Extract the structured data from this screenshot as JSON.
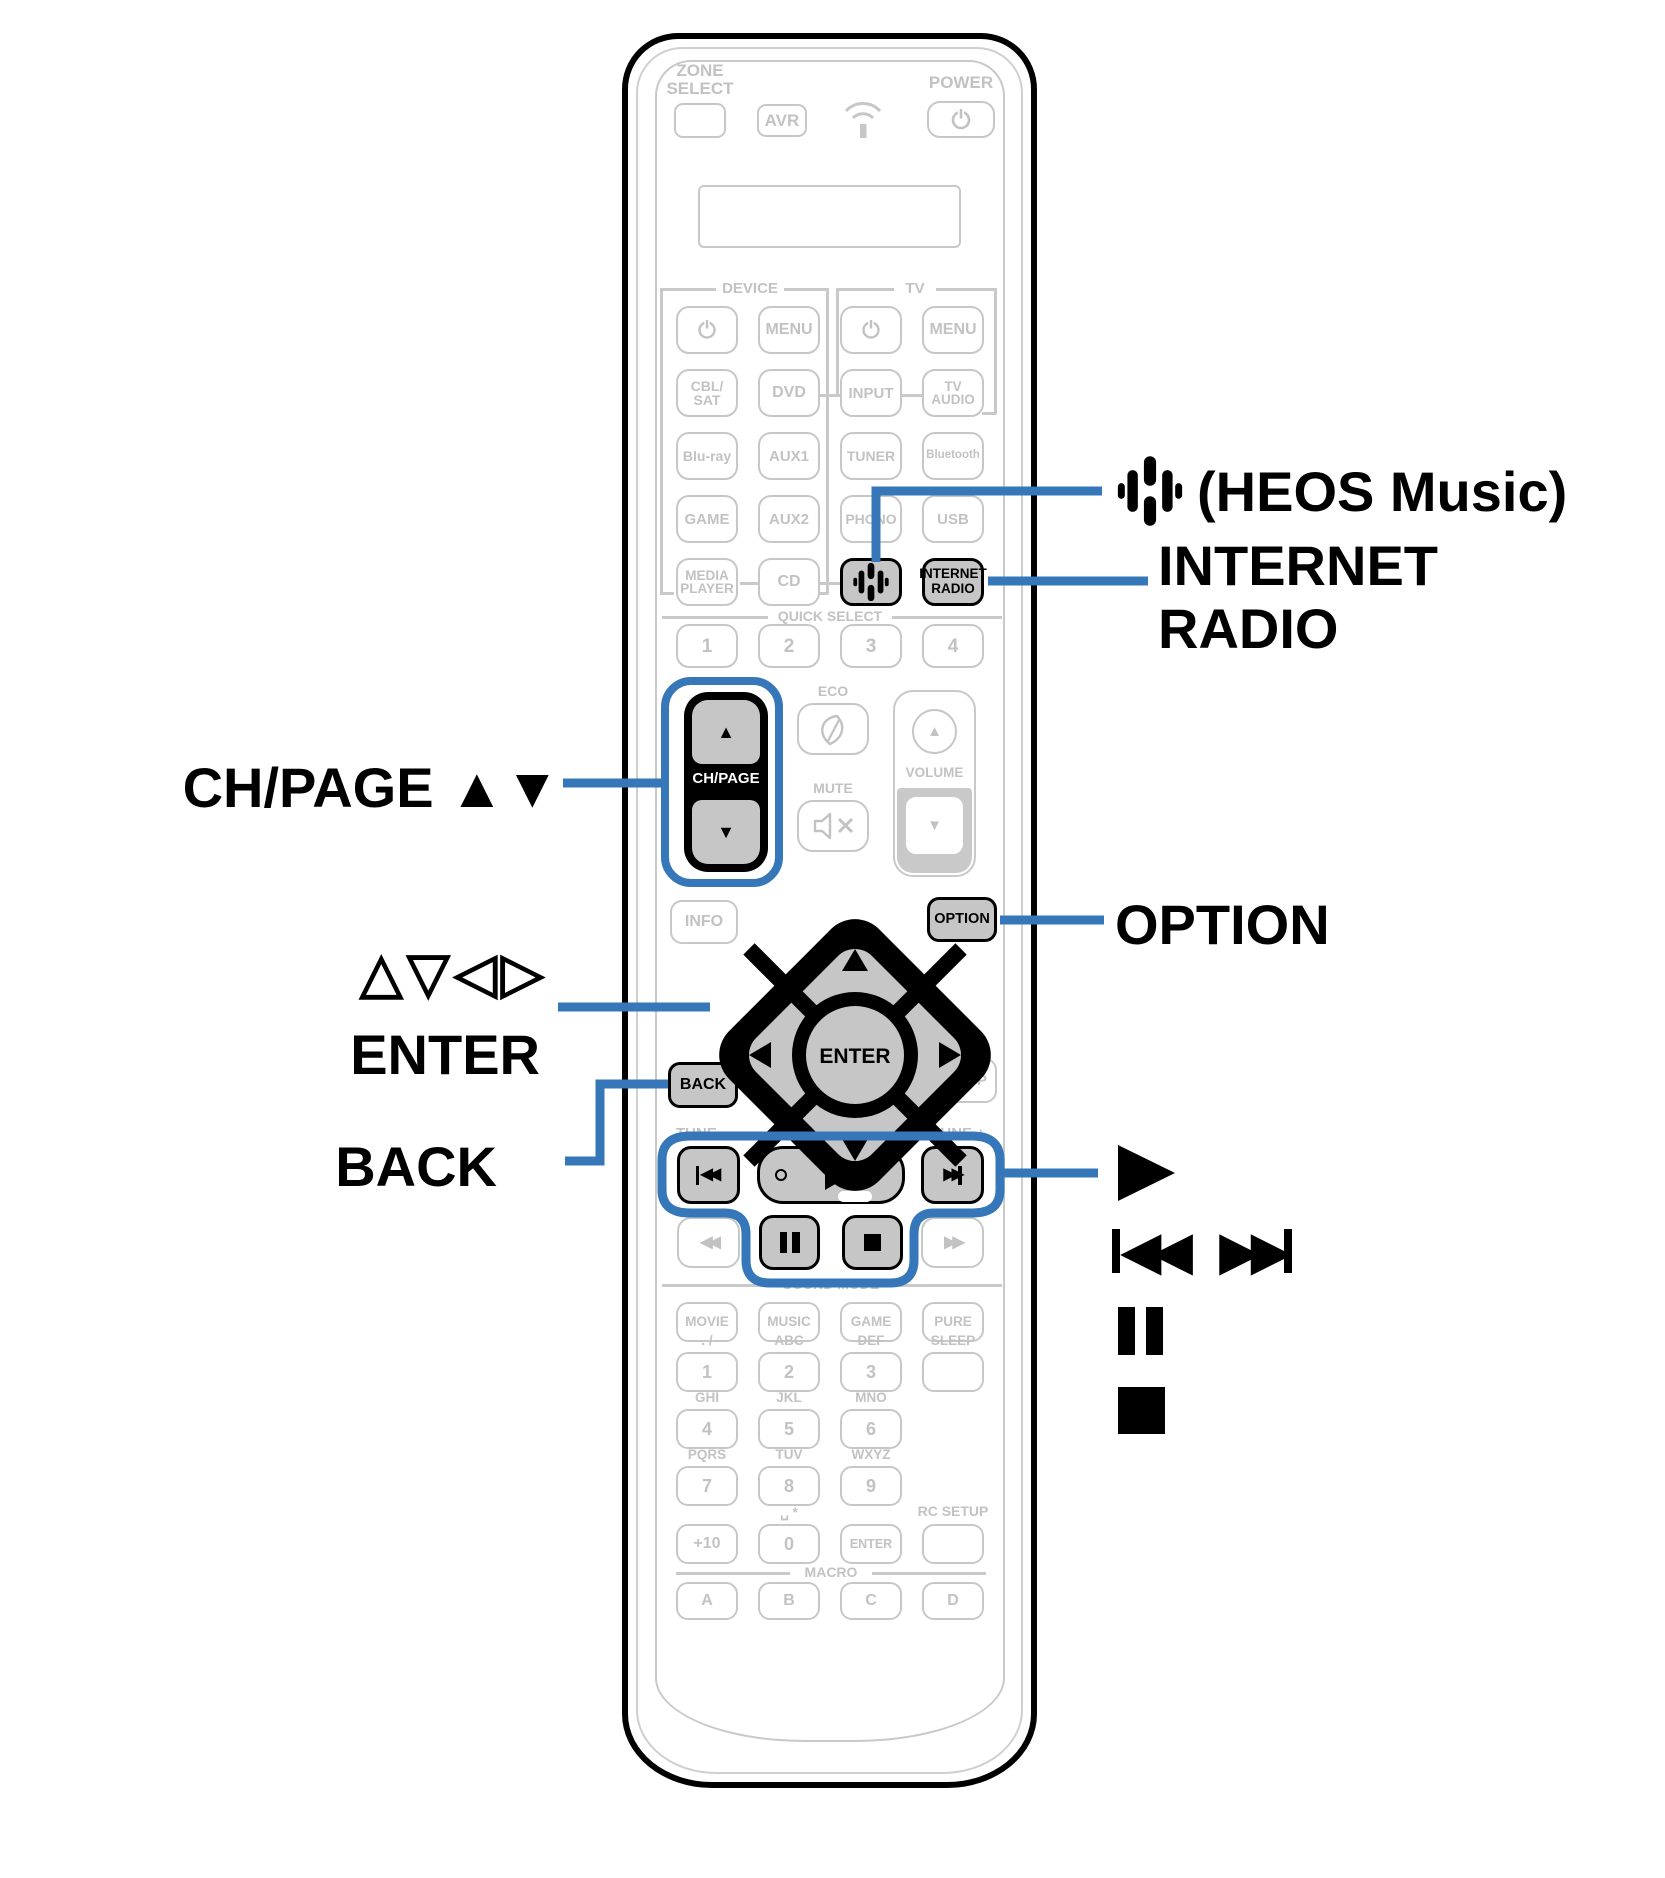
{
  "colors": {
    "callout_blue": "#3577b9",
    "line_gray": "#c9c9c9",
    "text_gray": "#c2c2c2",
    "highlight_fill": "#c6c6c6"
  },
  "glyphs": {
    "up": "▲",
    "down": "▼",
    "rew": "◀◀",
    "ff": "▶▶"
  },
  "remote": {
    "zone_select": [
      "ZONE",
      "SELECT"
    ],
    "avr": "AVR",
    "power": "POWER",
    "sections": {
      "device": "DEVICE",
      "tv": "TV",
      "quick_select": "QUICK SELECT",
      "sound_mode": "SOUND MODE",
      "macro": "MACRO"
    },
    "buttons": {
      "menu_device": "MENU",
      "menu_tv": "MENU",
      "cbl_sat": [
        "CBL/",
        "SAT"
      ],
      "dvd": "DVD",
      "input": "INPUT",
      "tv_audio": [
        "TV",
        "AUDIO"
      ],
      "blu_ray": "Blu-ray",
      "aux1": "AUX1",
      "tuner": "TUNER",
      "bluetooth": "Bluetooth",
      "game": "GAME",
      "aux2": "AUX2",
      "phono": "PHONO",
      "usb": "USB",
      "media_player": [
        "MEDIA",
        "PLAYER"
      ],
      "cd": "CD",
      "internet_radio": [
        "INTERNET",
        "RADIO"
      ],
      "quick_select": [
        "1",
        "2",
        "3",
        "4"
      ],
      "eco": "ECO",
      "mute": "MUTE",
      "volume": "VOLUME",
      "ch_page": "CH/PAGE",
      "info": "INFO",
      "option": "OPTION",
      "setup": "SETUP",
      "back": "BACK",
      "enter": "ENTER",
      "tune_minus": "TUNE —",
      "tune_plus": "TUNE +",
      "sound_mode": [
        "MOVIE",
        "MUSIC",
        "GAME",
        "PURE"
      ],
      "macro": [
        "A",
        "B",
        "C",
        "D"
      ],
      "digits": [
        "1",
        "2",
        "3",
        "4",
        "5",
        "6",
        "7",
        "8",
        "9"
      ],
      "plus10": "+10",
      "zero": "0",
      "numpad_enter": "ENTER"
    },
    "numpad_labels": {
      "dot_slash": ". /",
      "abc": "ABC",
      "def": "DEF",
      "sleep": "SLEEP",
      "ghi": "GHI",
      "jkl": "JKL",
      "mno": "MNO",
      "pqrs": "PQRS",
      "tuv": "TUV",
      "wxyz": "WXYZ",
      "space_star": "␣ *",
      "rc_setup": "RC SETUP"
    }
  },
  "callouts": {
    "ch_page": "CH/PAGE ▲▼",
    "cursor": "△▽◁▷",
    "enter": "ENTER",
    "back": "BACK",
    "heos": "(HEOS Music)",
    "internet_radio": [
      "INTERNET",
      "RADIO"
    ],
    "option": "OPTION"
  }
}
